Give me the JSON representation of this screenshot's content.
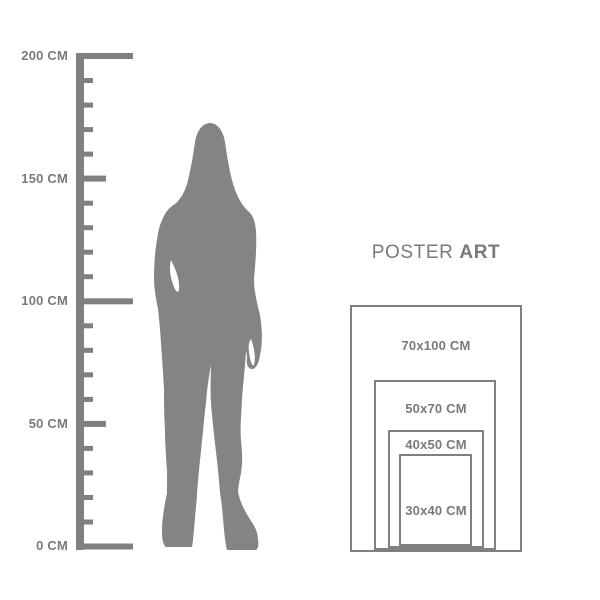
{
  "title": "Poster size guide",
  "colors": {
    "background": "#ffffff",
    "shape_gray": "#808080",
    "text_gray": "#7a7a7a",
    "silhouette_gray": "#848484"
  },
  "ruler": {
    "unit": "CM",
    "max_cm": 200,
    "labels": [
      {
        "text": "200 CM",
        "cm": 200
      },
      {
        "text": "150 CM",
        "cm": 150
      },
      {
        "text": "100 CM",
        "cm": 100
      },
      {
        "text": "50 CM",
        "cm": 50
      },
      {
        "text": "0 CM",
        "cm": 0
      }
    ]
  },
  "figure": {
    "alt": "standing woman silhouette"
  },
  "poster": {
    "brand": {
      "regular": "POSTER",
      "bold": "ART"
    },
    "sizes": [
      {
        "label": "70x100 CM",
        "width_cm": 70,
        "height_cm": 100
      },
      {
        "label": "50x70 CM",
        "width_cm": 50,
        "height_cm": 70
      },
      {
        "label": "40x50 CM",
        "width_cm": 40,
        "height_cm": 50
      },
      {
        "label": "30x40 CM",
        "width_cm": 30,
        "height_cm": 40
      }
    ]
  }
}
